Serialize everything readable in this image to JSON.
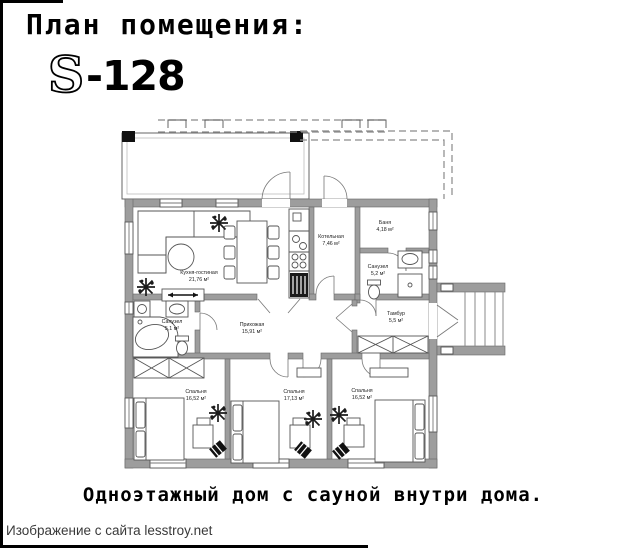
{
  "header": {
    "title": "План помещения:",
    "plan_code_s": "S",
    "plan_code_rest": "-128"
  },
  "caption": "Одноэтажный дом с сауной внутри дома.",
  "attribution": "Изображение с сайта lesstroy.net",
  "rooms": [
    {
      "name": "Кухня-гостиная",
      "area": "21,76 м²"
    },
    {
      "name": "Котельная",
      "area": "7,46 м²"
    },
    {
      "name": "Баня",
      "area": "4,18 м²"
    },
    {
      "name": "Санузел",
      "area": "5,2 м²"
    },
    {
      "name": "Тамбур",
      "area": "5,5 м²"
    },
    {
      "name": "Прихожая",
      "area": "15,91 м²"
    },
    {
      "name": "Санузел",
      "area": "5,1 м²"
    },
    {
      "name": "Спальня",
      "area": "16,52 м²"
    },
    {
      "name": "Спальня",
      "area": "17,13 м²"
    },
    {
      "name": "Спальня",
      "area": "16,52 м²"
    }
  ],
  "colors": {
    "wall_gray": "#9d9d9d",
    "accent_black": "#000000"
  }
}
